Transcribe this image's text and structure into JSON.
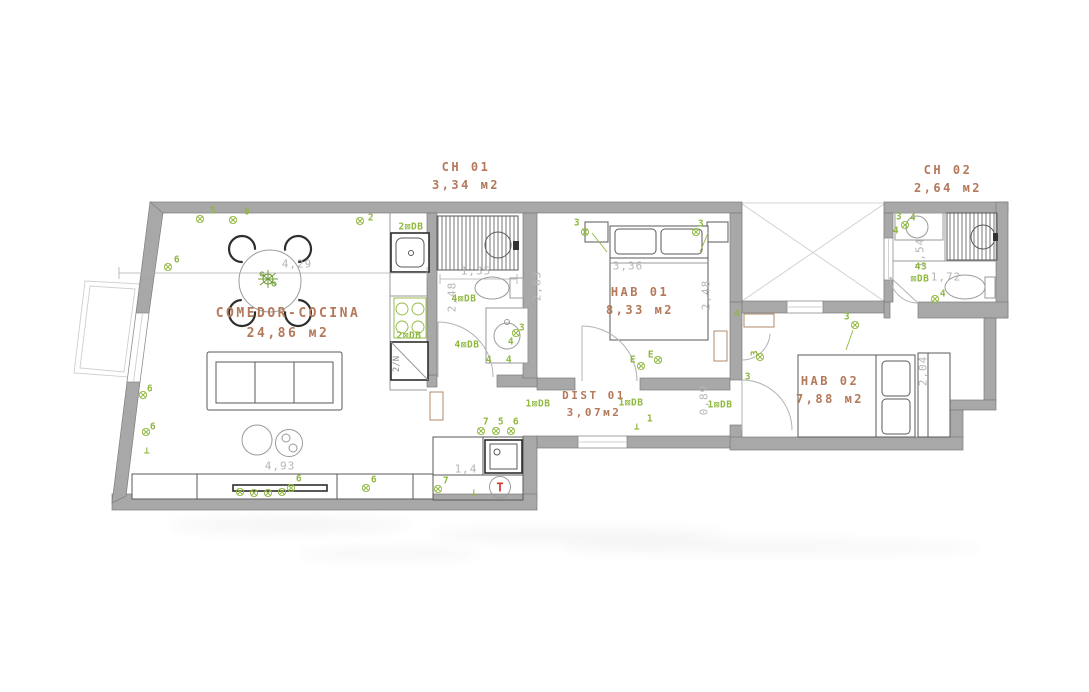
{
  "title": "apartment floor plan",
  "colors": {
    "wall": "#a8a8a8",
    "room": "#b4795a",
    "ann": "#8fb83e",
    "dim": "#b5b5b5",
    "thermo": "#d23a2e"
  },
  "symbols": {
    "thermostat": "T",
    "fridge": "2/N"
  },
  "plan": {
    "rooms": [
      {
        "id": "comedor-cocina",
        "name": "COMEDOR-COCINA",
        "area": "24,86 м2",
        "x": 288,
        "y": 304,
        "size": 13
      },
      {
        "id": "ch-01",
        "name": "CH 01",
        "area": "3,34 м2",
        "x": 466,
        "y": 158,
        "size": 12
      },
      {
        "id": "ch-02",
        "name": "CH 02",
        "area": "2,64 м2",
        "x": 948,
        "y": 161,
        "size": 12
      },
      {
        "id": "hab-01",
        "name": "HAB 01",
        "area": "8,33 м2",
        "x": 640,
        "y": 283,
        "size": 12
      },
      {
        "id": "hab-02",
        "name": "HAB 02",
        "area": "7,88 м2",
        "x": 830,
        "y": 372,
        "size": 12
      },
      {
        "id": "dist-01",
        "name": "DIST 01",
        "area": "3,07м2",
        "x": 594,
        "y": 388,
        "size": 11
      }
    ],
    "dimensions": [
      {
        "t": "4,29",
        "x": 297,
        "y": 264,
        "rot": 0
      },
      {
        "t": "1,35",
        "x": 476,
        "y": 271,
        "rot": 0
      },
      {
        "t": "3,36",
        "x": 628,
        "y": 266,
        "rot": 0
      },
      {
        "t": "4,93",
        "x": 280,
        "y": 466,
        "rot": 0
      },
      {
        "t": "1,4",
        "x": 466,
        "y": 469,
        "rot": 0
      },
      {
        "t": "1,72",
        "x": 946,
        "y": 277,
        "rot": 0
      },
      {
        "t": "2,63",
        "x": 537,
        "y": 286,
        "rot": -90
      },
      {
        "t": "2,48",
        "x": 452,
        "y": 297,
        "rot": -90
      },
      {
        "t": "2,48",
        "x": 706,
        "y": 295,
        "rot": -90
      },
      {
        "t": "0,89",
        "x": 704,
        "y": 400,
        "rot": -90
      },
      {
        "t": "2,04",
        "x": 923,
        "y": 371,
        "rot": -90
      },
      {
        "t": "1,54",
        "x": 920,
        "y": 253,
        "rot": -90
      }
    ],
    "annotations": [
      {
        "t": "5",
        "x": 213,
        "y": 211
      },
      {
        "t": "6",
        "x": 247,
        "y": 212
      },
      {
        "t": "2",
        "x": 371,
        "y": 218
      },
      {
        "t": "2⊠DB",
        "x": 411,
        "y": 227
      },
      {
        "t": "6",
        "x": 177,
        "y": 260
      },
      {
        "t": "6",
        "x": 150,
        "y": 389
      },
      {
        "t": "6",
        "x": 153,
        "y": 427
      },
      {
        "t": "6",
        "x": 299,
        "y": 479
      },
      {
        "t": "6",
        "x": 374,
        "y": 480
      },
      {
        "t": "7",
        "x": 446,
        "y": 481
      },
      {
        "t": "7",
        "x": 486,
        "y": 422
      },
      {
        "t": "5",
        "x": 501,
        "y": 422
      },
      {
        "t": "6",
        "x": 516,
        "y": 422
      },
      {
        "t": "1⊠DB",
        "x": 538,
        "y": 404
      },
      {
        "t": "1⊠DB",
        "x": 631,
        "y": 403
      },
      {
        "t": "1⊠DB",
        "x": 720,
        "y": 405
      },
      {
        "t": "1",
        "x": 650,
        "y": 419
      },
      {
        "t": "⊥",
        "x": 637,
        "y": 427
      },
      {
        "t": "⊥",
        "x": 474,
        "y": 493
      },
      {
        "t": "⊥",
        "x": 147,
        "y": 451
      },
      {
        "t": "3",
        "x": 577,
        "y": 223
      },
      {
        "t": "3",
        "x": 701,
        "y": 224
      },
      {
        "t": "E",
        "x": 633,
        "y": 360
      },
      {
        "t": "E",
        "x": 651,
        "y": 355
      },
      {
        "t": "3",
        "x": 522,
        "y": 328
      },
      {
        "t": "4⊠DB",
        "x": 464,
        "y": 299
      },
      {
        "t": "4⊠DB",
        "x": 467,
        "y": 345
      },
      {
        "t": "4",
        "x": 511,
        "y": 342
      },
      {
        "t": "4",
        "x": 489,
        "y": 360
      },
      {
        "t": "4",
        "x": 509,
        "y": 360
      },
      {
        "t": "2⊠DB",
        "x": 409,
        "y": 336
      },
      {
        "t": "3",
        "x": 847,
        "y": 317
      },
      {
        "t": "4",
        "x": 737,
        "y": 314
      },
      {
        "t": "3",
        "x": 755,
        "y": 353,
        "rot": -90
      },
      {
        "t": "3",
        "x": 748,
        "y": 377
      },
      {
        "t": "3",
        "x": 899,
        "y": 217
      },
      {
        "t": "4",
        "x": 913,
        "y": 218
      },
      {
        "t": "4",
        "x": 896,
        "y": 231
      },
      {
        "t": "43",
        "x": 921,
        "y": 267
      },
      {
        "t": "⊠DB",
        "x": 920,
        "y": 279
      },
      {
        "t": "4",
        "x": 943,
        "y": 294
      }
    ],
    "light_glyphs": [
      [
        200,
        219
      ],
      [
        233,
        220
      ],
      [
        360,
        221
      ],
      [
        168,
        267
      ],
      [
        143,
        395
      ],
      [
        146,
        432
      ],
      [
        291,
        488
      ],
      [
        366,
        488
      ],
      [
        438,
        489
      ],
      [
        481,
        431
      ],
      [
        496,
        431
      ],
      [
        511,
        431
      ],
      [
        585,
        232
      ],
      [
        696,
        232
      ],
      [
        641,
        366
      ],
      [
        658,
        360
      ],
      [
        855,
        325
      ],
      [
        760,
        357
      ],
      [
        905,
        225
      ],
      [
        935,
        299
      ],
      [
        516,
        333
      ],
      [
        240,
        492
      ],
      [
        254,
        493
      ],
      [
        268,
        493
      ],
      [
        282,
        492
      ]
    ]
  }
}
